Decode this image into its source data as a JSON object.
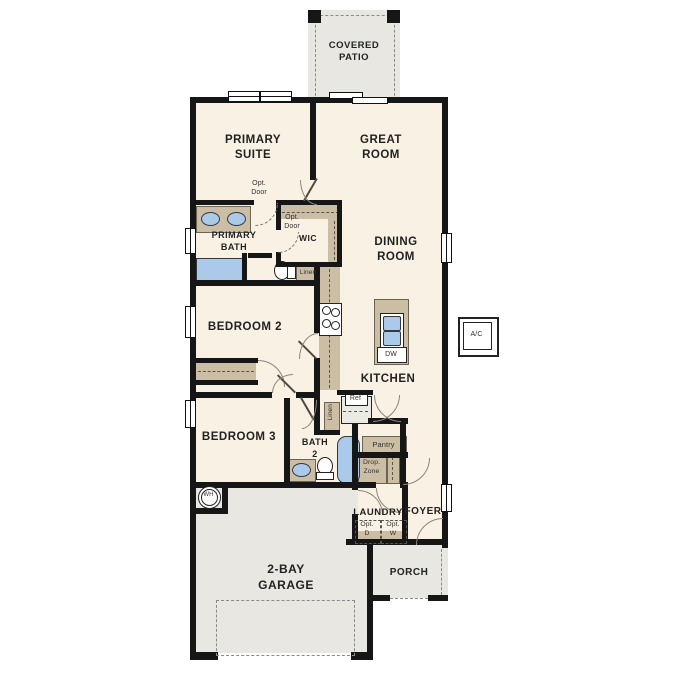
{
  "type": "residential-floor-plan",
  "labels": {
    "covered_patio": "COVERED\nPATIO",
    "primary_suite": "PRIMARY\nSUITE",
    "great_room": "GREAT\nROOM",
    "opt_door_suite": "Opt.\nDoor",
    "opt_door_wic": "Opt.\nDoor",
    "primary_bath": "PRIMARY\nBATH",
    "wic": "WIC",
    "dining_room": "DINING\nROOM",
    "linen_bath": "Linen",
    "bedroom_2": "BEDROOM 2",
    "kitchen": "KITCHEN",
    "dw": "DW",
    "ref": "Ref",
    "bedroom_3": "BEDROOM 3",
    "bath_2": "BATH\n2",
    "linen_hall": "Linen",
    "pantry": "Pantry",
    "drop_zone": "Drop.\nZone",
    "wh": "WH",
    "laundry": "LAUNDRY",
    "opt_dryer": "Opt.\nD",
    "opt_washer": "Opt.\nW",
    "foyer": "FOYER",
    "garage": "2-BAY\nGARAGE",
    "porch": "PORCH",
    "ac": "A/C"
  },
  "colors": {
    "floor": "#f9f1e3",
    "exterior_concrete": "#e8e7e2",
    "wall": "#161616",
    "casework": "#ccbea5",
    "plumbing_fixture": "#abc9e9"
  }
}
